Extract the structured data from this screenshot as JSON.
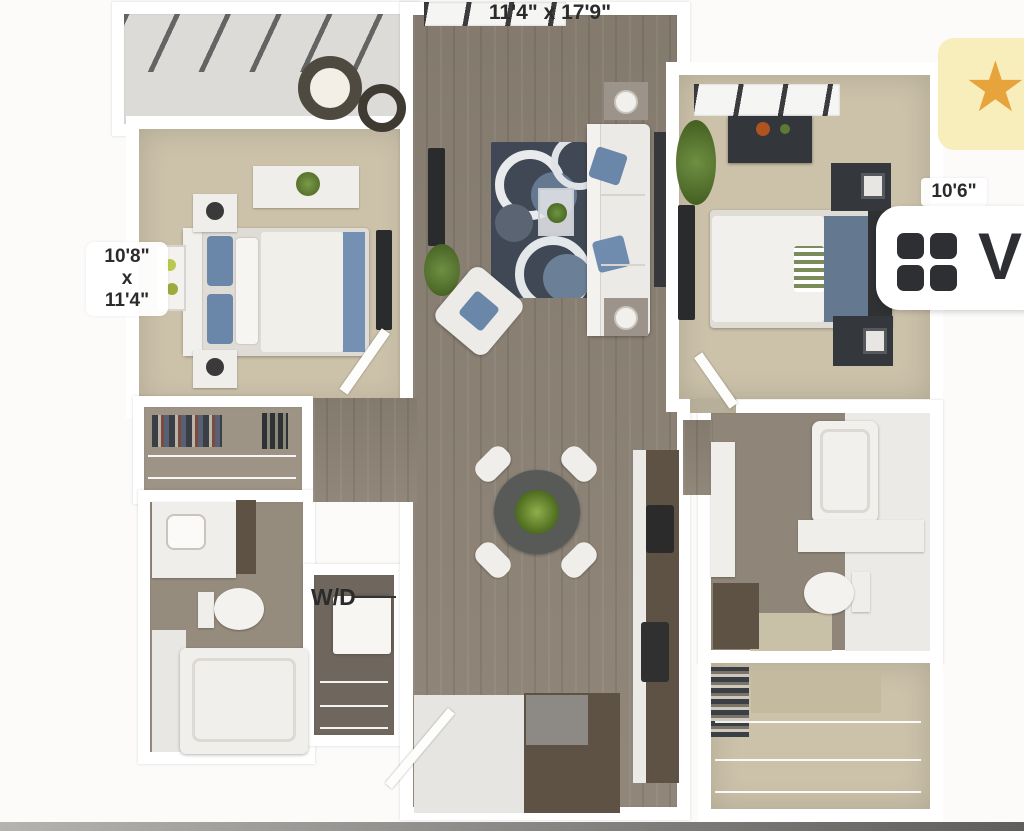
{
  "labels": {
    "living_dims": "11'4\" x 17'9\"",
    "bedroom_left_dims": {
      "line1": "10'8\"",
      "line2": "x",
      "line3": "11'4\""
    },
    "bedroom_right_dims": "10'6\"",
    "washer_dryer": "W/D"
  },
  "buttons": {
    "favorite": {
      "glyph": "★"
    },
    "view": {
      "label": "V"
    }
  },
  "colors": {
    "wall": "#ffffff",
    "bg": "#fcfbf9",
    "wood": "#8c8275",
    "wood-dark": "#6f675d",
    "carpet": "#ccc2aa",
    "balcony-floor": "#dcdbd8",
    "closet-back": "#9e9486",
    "rug": "#3f4854",
    "rug-blue": "#64788f",
    "counter-brown": "#5e5245",
    "fav-bg": "#f7eebc",
    "star": "#e7a43d",
    "icon-dark": "#2d2f33",
    "text-dark": "#2b2b2b",
    "bed-blue": "#6a86a8"
  }
}
